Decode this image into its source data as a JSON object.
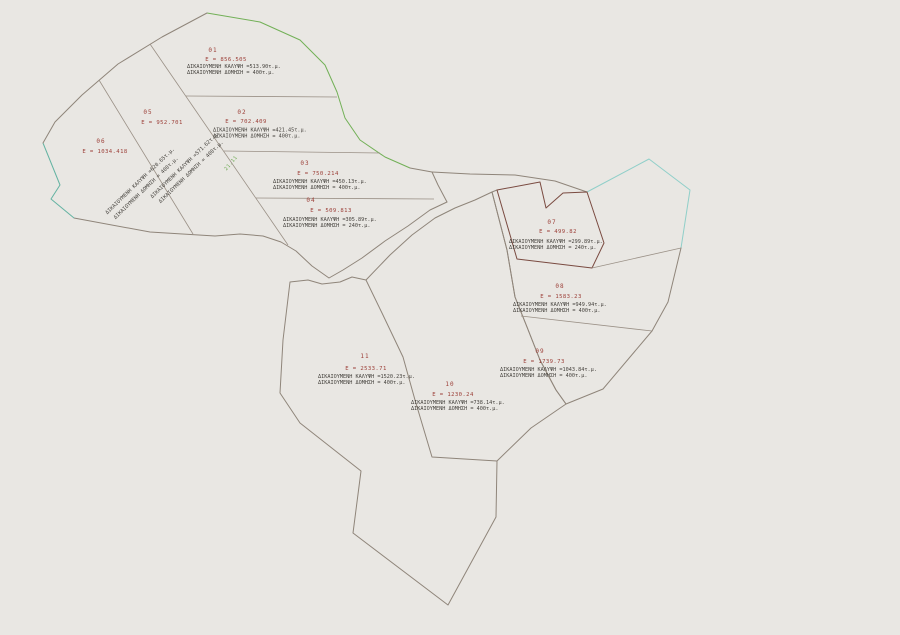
{
  "drawing": {
    "type": "cadastral-parcel-plan",
    "background_color": "#e9e7e3",
    "colors": {
      "boundary_gray": "#8f857a",
      "boundary_green": "#72b057",
      "boundary_teal": "#64b3a2",
      "boundary_cyan": "#90cfc9",
      "boundary_maroon": "#7a4b41",
      "text_red": "#9c3f38",
      "text_dark": "#45423d",
      "text_green": "#6aa84f"
    },
    "distance_label": "21.11"
  },
  "parcels": [
    {
      "number": "01",
      "area_label": "E = 856.505",
      "coverage_label": "ΔΙΚΑΙΟΥΜΕΝΗ ΚΑΛΥΨΗ =513.90τ.μ.",
      "build_label": "ΔΙΚΑΙΟΥΜΕΝΗ ΔΟΜΗΣΗ = 400τ.μ."
    },
    {
      "number": "02",
      "area_label": "E = 702.409",
      "coverage_label": "ΔΙΚΑΙΟΥΜΕΝΗ ΚΑΛΥΨΗ =421.45τ.μ.",
      "build_label": "ΔΙΚΑΙΟΥΜΕΝΗ ΔΟΜΗΣΗ = 400τ.μ."
    },
    {
      "number": "03",
      "area_label": "E = 750.214",
      "coverage_label": "ΔΙΚΑΙΟΥΜΕΝΗ ΚΑΛΥΨΗ =450.13τ.μ.",
      "build_label": "ΔΙΚΑΙΟΥΜΕΝΗ ΔΟΜΗΣΗ = 400τ.μ."
    },
    {
      "number": "04",
      "area_label": "E = 509.813",
      "coverage_label": "ΔΙΚΑΙΟΥΜΕΝΗ ΚΑΛΥΨΗ =305.89τ.μ.",
      "build_label": "ΔΙΚΑΙΟΥΜΕΝΗ ΔΟΜΗΣΗ = 240τ.μ."
    },
    {
      "number": "05",
      "area_label": "E = 952.701",
      "coverage_label": "ΔΙΚΑΙΟΥΜΕΝΗ ΚΑΛΥΨΗ =571.62τ.μ.",
      "build_label": "ΔΙΚΑΙΟΥΜΕΝΗ ΔΟΜΗΣΗ = 400τ.μ."
    },
    {
      "number": "06",
      "area_label": "E = 1034.418",
      "coverage_label": "ΔΙΚΑΙΟΥΜΕΝΗ ΚΑΛΥΨΗ =620.65τ.μ.",
      "build_label": "ΔΙΚΑΙΟΥΜΕΝΗ ΔΟΜΗΣΗ = 400τ.μ."
    },
    {
      "number": "07",
      "area_label": "E = 499.82",
      "coverage_label": "ΔΙΚΑΙΟΥΜΕΝΗ ΚΑΛΥΨΗ =299.89τ.μ.",
      "build_label": "ΔΙΚΑΙΟΥΜΕΝΗ ΔΟΜΗΣΗ = 240τ.μ."
    },
    {
      "number": "08",
      "area_label": "E = 1583.23",
      "coverage_label": "ΔΙΚΑΙΟΥΜΕΝΗ ΚΑΛΥΨΗ =949.94τ.μ.",
      "build_label": "ΔΙΚΑΙΟΥΜΕΝΗ ΔΟΜΗΣΗ = 400τ.μ."
    },
    {
      "number": "09",
      "area_label": "E = 1739.73",
      "coverage_label": "ΔΙΚΑΙΟΥΜΕΝΗ ΚΑΛΥΨΗ =1043.84τ.μ.",
      "build_label": "ΔΙΚΑΙΟΥΜΕΝΗ ΔΟΜΗΣΗ = 400τ.μ."
    },
    {
      "number": "10",
      "area_label": "E = 1230.24",
      "coverage_label": "ΔΙΚΑΙΟΥΜΕΝΗ ΚΑΛΥΨΗ =738.14τ.μ.",
      "build_label": "ΔΙΚΑΙΟΥΜΕΝΗ ΔΟΜΗΣΗ = 400τ.μ."
    },
    {
      "number": "11",
      "area_label": "E = 2533.71",
      "coverage_label": "ΔΙΚΑΙΟΥΜΕΝΗ ΚΑΛΥΨΗ =1520.23τ.μ.",
      "build_label": "ΔΙΚΑΙΟΥΜΕΝΗ ΔΟΜΗΣΗ = 400τ.μ."
    }
  ]
}
